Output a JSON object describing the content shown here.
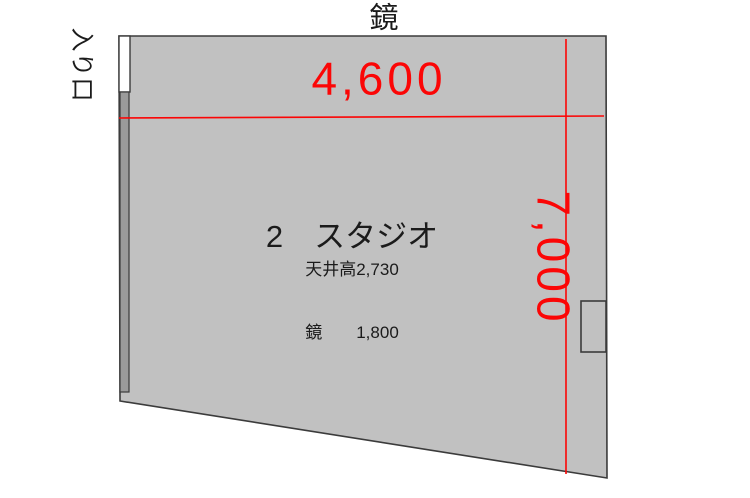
{
  "plan": {
    "mirror_label": "鏡",
    "entrance_label": "入り口",
    "room_name": "2　スタジオ",
    "ceiling_height": "天井高2,730",
    "mirror_height": "鏡　　1,800",
    "width_dimension": "4,600",
    "depth_dimension": "7,000"
  },
  "colors": {
    "background": "#ffffff",
    "room_fill": "#c1c1c1",
    "wall_strip_fill": "#9b9b9b",
    "outline": "#3b3b3b",
    "dimension_red": "#fb0606",
    "text_black": "#1b1b1b",
    "door_white": "#ffffff"
  }
}
